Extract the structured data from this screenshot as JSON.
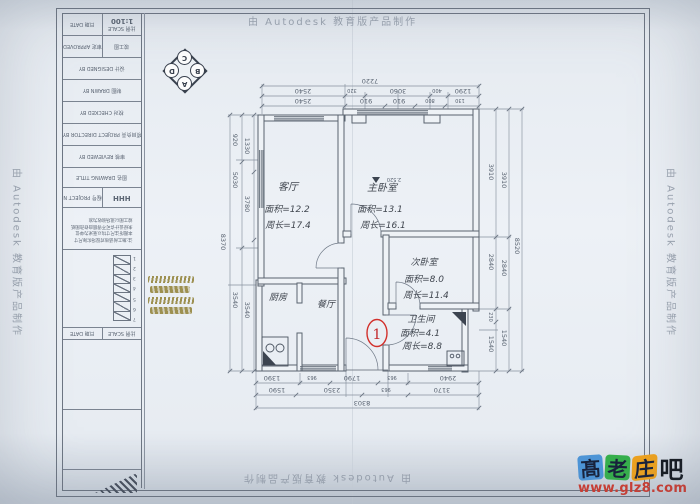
{
  "palette": {
    "ink": "#59636f",
    "dim_text": "#555f6d",
    "handwriting": "#40464f",
    "red_marker": "#d2302c",
    "olive_note": "#8f7f33",
    "paper": "#edf1f6",
    "site_blue": "#4d96d9",
    "site_green": "#35b14b",
    "site_orange": "#f0a31d",
    "site_url_red": "#d03a2e"
  },
  "watermark": {
    "autodesk": "由 Autodesk 教育版产品制作"
  },
  "site": {
    "chars": [
      "髙",
      "老",
      "庄",
      "吧"
    ],
    "url": "www.glz8.com"
  },
  "logo": {
    "top": "C",
    "left": "D",
    "right": "B",
    "bottom": "A"
  },
  "titleblock": {
    "scale": "1:100",
    "scale_label": "比例 SCALE",
    "date_label": "日期 DATE",
    "approved": "审定 APPROVED",
    "status": "竣工图",
    "designed": "设计 DESIGNED BY",
    "drawn": "制图 DRAWN BY",
    "checked": "校对 CHECKED BY",
    "director": "项目负责 PROJECT DIRECTOR BY",
    "reviewed": "审核 REVIEWED BY",
    "drawing_title": "图名 DRAWING TITLE",
    "project_no": "工程号 PROJECT NO.",
    "project_no_value": "HHH",
    "notes": [
      "注:施工前请核对现场实际尺寸",
      "本图所注尺寸均以毫米为单位",
      "未经设计许可不得擅自修改图纸",
      "竣工图以现场验收为准"
    ],
    "date2": "日期 DATE",
    "scale2": "比例 SCALE",
    "rev": [
      "1",
      "2",
      "3",
      "4",
      "5",
      "6",
      "7"
    ]
  },
  "plan": {
    "marker": "1",
    "elevation": "2.520",
    "rooms": [
      {
        "name": "客厅",
        "area": "面积=12.2",
        "perimeter": "周长=17.4"
      },
      {
        "name": "主卧室",
        "area": "面积=13.1",
        "perimeter": "周长=16.1"
      },
      {
        "name": "次卧室",
        "area": "面积=8.0",
        "perimeter": "周长=11.4"
      },
      {
        "name": "卫生间",
        "area": "面积=4.1",
        "perimeter": "周长=8.8"
      },
      {
        "name": "厨房"
      },
      {
        "name": "餐厅"
      }
    ]
  },
  "dims": {
    "top": {
      "overall": "7220",
      "chain1": [
        "2540",
        "320",
        "3060",
        "400",
        "1290"
      ],
      "chain2": [
        "2540",
        "910",
        "910",
        "800",
        "130"
      ]
    },
    "bottom": {
      "overall": "8303",
      "chainA": [
        "1390",
        "963",
        "1790",
        "963",
        "2940"
      ],
      "chainB": [
        "1590",
        "2350",
        "963",
        "3170"
      ]
    },
    "left": {
      "overall": "8370",
      "chain1": [
        "920",
        "5030",
        "3540"
      ],
      "chain2": [
        "1330",
        "3780",
        "3540"
      ]
    },
    "right": {
      "overall": "8520",
      "chain1": [
        "3910",
        "2840",
        "230",
        "1540"
      ],
      "chain2": [
        "3910",
        "2840",
        "1540"
      ]
    }
  }
}
